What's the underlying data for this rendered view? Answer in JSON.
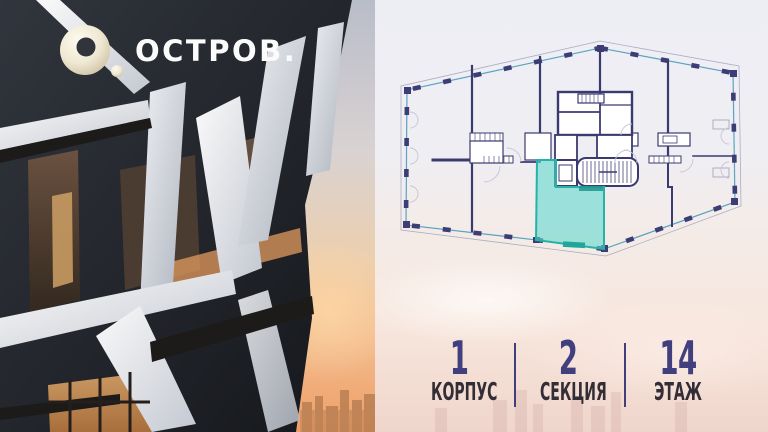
{
  "brand": {
    "name": "ОСТРОВ."
  },
  "panel": {
    "floorplan": {
      "type": "floor-plan",
      "building_shape": "irregular-hexagon-footprint",
      "walls_color": "#3b3a70",
      "glazing_color": "#6cc0d2",
      "highlighted_unit": {
        "fill": "#61d8ce",
        "outline": "#27b2a7",
        "position": "bottom-center-adjacent-to-stair-core"
      }
    },
    "stats": {
      "items": [
        {
          "value": "1",
          "label": "КОРПУС"
        },
        {
          "value": "2",
          "label": "СЕКЦИЯ"
        },
        {
          "value": "14",
          "label": "ЭТАЖ"
        }
      ],
      "value_color": "#413f7e",
      "label_color": "#332d35"
    }
  }
}
